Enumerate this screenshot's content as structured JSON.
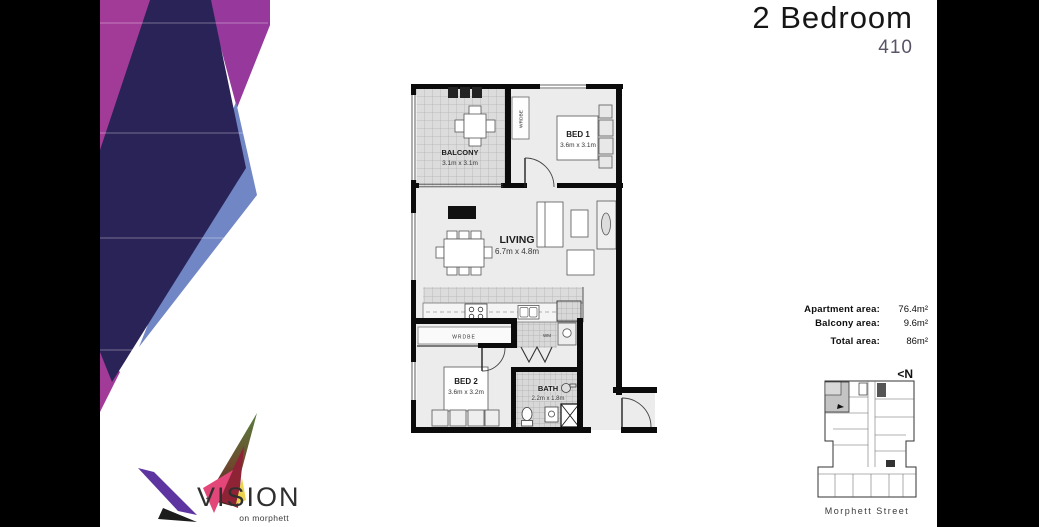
{
  "header": {
    "title": "2 Bedroom",
    "unit": "410"
  },
  "logo": {
    "wordmark": "VISION",
    "tagline": "on morphett"
  },
  "floor_plan": {
    "balcony": {
      "name": "BALCONY",
      "dims": "3.1m x 3.1m"
    },
    "bed1": {
      "name": "BED 1",
      "dims": "3.6m x 3.1m"
    },
    "living": {
      "name": "LIVING",
      "dims": "6.7m x 4.8m"
    },
    "bed2": {
      "name": "BED 2",
      "dims": "3.6m x 3.2m"
    },
    "bath": {
      "name": "BATH",
      "dims": "2.2m x 1.8m"
    },
    "wardrobe_label": "WRDBE",
    "wardrobe_label_2": "WRDBE",
    "washing_machine_label": "WM"
  },
  "areas": {
    "apartment": {
      "label": "Apartment area:",
      "value": "76.4m²"
    },
    "balcony": {
      "label": "Balcony area:",
      "value": "9.6m²"
    },
    "total": {
      "label": "Total area:",
      "value": "86m²"
    }
  },
  "key_plan": {
    "north": "<N",
    "street": "Morphett Street"
  },
  "colors": {
    "accent_magenta": "#a23a98",
    "accent_navy": "#2a2357",
    "accent_blue": "#7186c4",
    "unit_number_color": "#5a5366"
  }
}
